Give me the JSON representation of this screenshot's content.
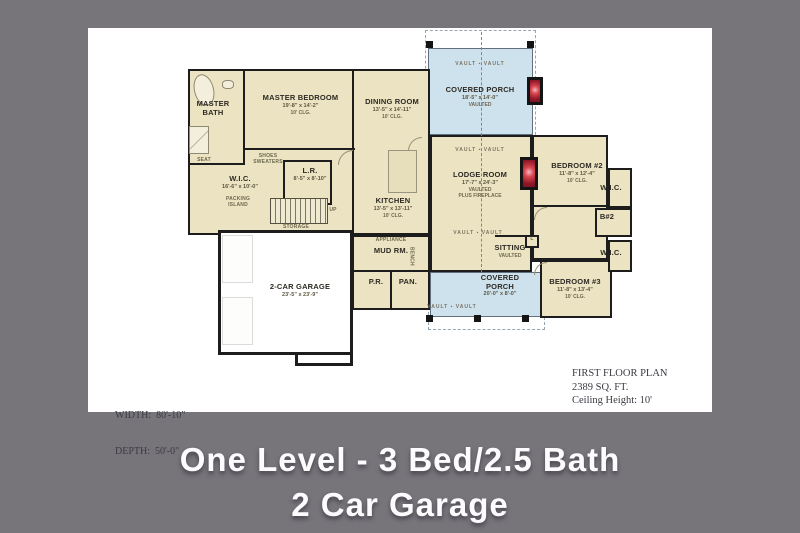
{
  "colors": {
    "background": "#77747a",
    "sheet": "#ffffff",
    "room_fill": "#ebe3c1",
    "porch_fill": "#cee2ed",
    "wall": "#1d1d1d",
    "fireplace_red": "#8e1728",
    "caption_text": "#fcfbfd"
  },
  "caption": {
    "line1": "One Level - 3 Bed/2.5 Bath",
    "line2": "2 Car Garage"
  },
  "annotations": {
    "width": "WIDTH:  80'-10\"",
    "depth": "DEPTH:  50'-0\"",
    "plan_title": "FIRST FLOOR PLAN",
    "plan_area": "2389 SQ. FT.",
    "plan_ceiling": "Ceiling Height: 10'"
  },
  "rooms": {
    "master_bath": {
      "name": "MASTER BATH"
    },
    "master_bedroom": {
      "name": "MASTER BEDROOM",
      "dims": "19'-8\" x 14'-2\"",
      "clg": "10' CLG."
    },
    "dining_room": {
      "name": "DINING ROOM",
      "dims": "13'-5\" x 14'-11\"",
      "clg": "10' CLG."
    },
    "covered_porch_top": {
      "name": "COVERED PORCH",
      "dims": "18'-5\" x 14'-0\"",
      "note": "VAULTED"
    },
    "wic_master": {
      "name": "W.I.C.",
      "dims": "16'-6\" x 10'-0\""
    },
    "laundry": {
      "name": "L.R.",
      "dims": "8'-5\" x 8'-10\""
    },
    "kitchen": {
      "name": "KITCHEN",
      "dims": "13'-5\" x 13'-11\"",
      "clg": "10' CLG."
    },
    "lodge_room": {
      "name": "LODGE ROOM",
      "dims": "17'-7\" x 24'-3\"",
      "note": "VAULTED",
      "note2": "PLUS FIREPLACE"
    },
    "bedroom_2": {
      "name": "BEDROOM #2",
      "dims": "11'-8\" x 12'-4\"",
      "clg": "10' CLG."
    },
    "wic_2": {
      "name": "W.I.C."
    },
    "bath_2": {
      "name": "B#2"
    },
    "wic_3": {
      "name": "W.I.C."
    },
    "bedroom_3": {
      "name": "BEDROOM #3",
      "dims": "11'-8\" x 13'-4\"",
      "clg": "10' CLG."
    },
    "sitting": {
      "name": "SITTING",
      "note": "VAULTED"
    },
    "covered_porch_bottom": {
      "name": "COVERED PORCH",
      "dims": "20'-0\" x 8'-0\""
    },
    "mud_room": {
      "name": "MUD RM."
    },
    "powder_room": {
      "name": "P.R."
    },
    "pantry": {
      "name": "PAN."
    },
    "garage": {
      "name": "2-CAR GARAGE",
      "dims": "23'-5\" x 23'-9\""
    }
  },
  "labels": {
    "seat": "SEAT",
    "shoes": "SHOES SWEATERS",
    "packing": "PACKING ISLAND",
    "storage": "STORAGE",
    "up": "UP",
    "appliance": "APPLIANCE",
    "bench": "BENCH",
    "linen": "L",
    "vault": "VAULT ▪ VAULT"
  }
}
